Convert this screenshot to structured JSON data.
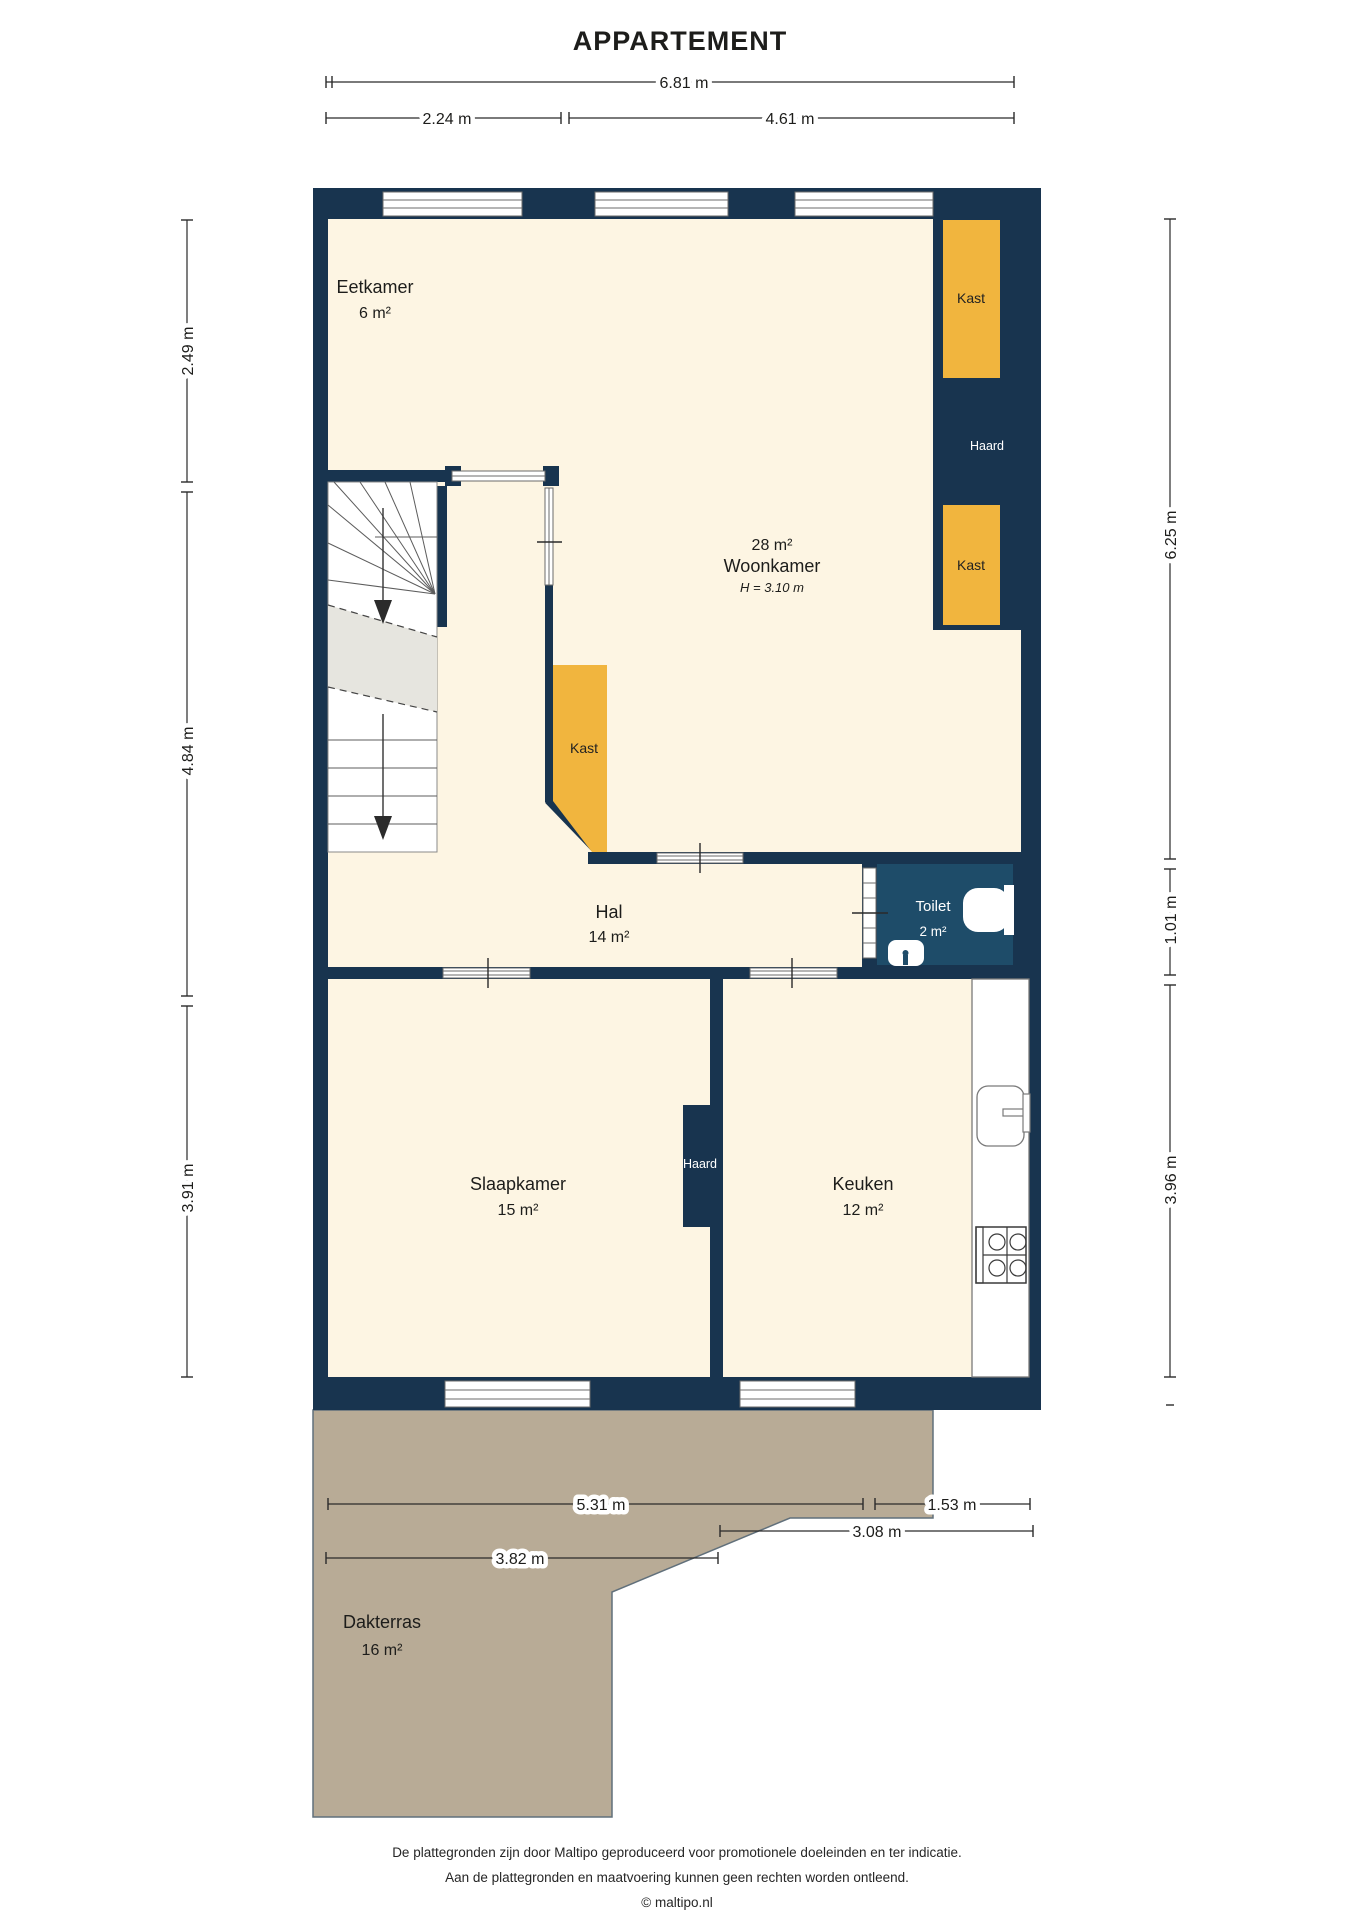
{
  "title": "APPARTEMENT",
  "colors": {
    "wall": "#18344f",
    "floor": "#fdf5e3",
    "kast": "#f1b53e",
    "toilet": "#1e4c69",
    "terrace": "#b8ab96",
    "terrace_edge": "#61707b",
    "landing": "#e6e5df"
  },
  "rooms": {
    "eetkamer": {
      "name": "Eetkamer",
      "area": "6 m²"
    },
    "woonkamer": {
      "area": "28 m²",
      "name": "Woonkamer",
      "height": "H = 3.10 m"
    },
    "hal": {
      "name": "Hal",
      "area": "14 m²"
    },
    "toilet": {
      "name": "Toilet",
      "area": "2 m²"
    },
    "slaapkamer": {
      "name": "Slaapkamer",
      "area": "15 m²"
    },
    "keuken": {
      "name": "Keuken",
      "area": "12 m²"
    },
    "dakterras": {
      "name": "Dakterras",
      "area": "16 m²"
    }
  },
  "fixtures": {
    "kast_top": "Kast",
    "kast_mid": "Kast",
    "kast_hall": "Kast",
    "haard_woonkamer": "Haard",
    "haard_slaapkamer": "Haard"
  },
  "dimensions": {
    "top_total": "6.81 m",
    "top_left": "2.24 m",
    "top_right": "4.61 m",
    "left": [
      "2.49 m",
      "4.84 m",
      "3.91 m"
    ],
    "right": [
      "6.25 m",
      "1.01 m",
      "3.96 m"
    ],
    "terrace": [
      "5.31 m",
      "1.53 m",
      "3.08 m",
      "3.82 m"
    ]
  },
  "footer": {
    "line1": "De plattegronden zijn door Maltipo geproduceerd voor promotionele doeleinden en ter indicatie.",
    "line2": "Aan de plattegronden en maatvoering kunnen geen rechten worden ontleend.",
    "line3": "© maltipo.nl"
  }
}
